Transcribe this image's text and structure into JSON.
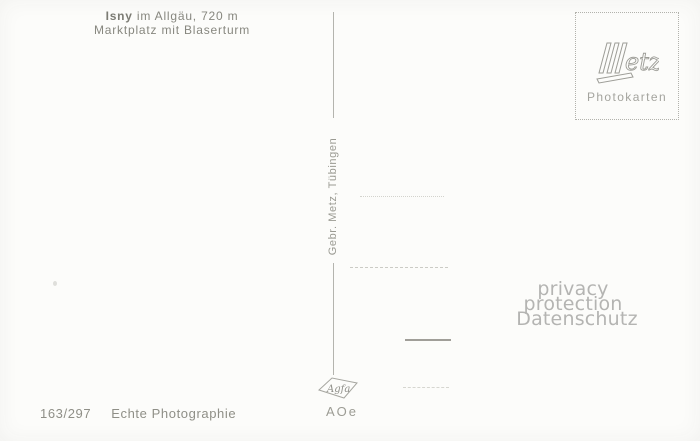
{
  "postcard": {
    "caption": {
      "place": "Isny",
      "place_detail": " im Allgäu, 720 m",
      "subtitle": "Marktplatz mit Blaserturm"
    },
    "publisher": "Gebr. Metz, Tübingen",
    "series_number": "163/297",
    "photo_label": "Echte Photographie",
    "film_code": "AOe",
    "agfa_logo_text": "Agfa"
  },
  "stamp_box": {
    "brand": "Metz",
    "brand_suffix": "etz",
    "label": "Photokarten"
  },
  "watermark": {
    "line1": "privacy protection",
    "line2": "Datenschutz"
  },
  "colors": {
    "paper": "#fcfcfa",
    "ink": "#87877f",
    "light_ink": "#a4a49e",
    "watermark": "#b4b4b2",
    "rule": "#cbcbc5"
  }
}
